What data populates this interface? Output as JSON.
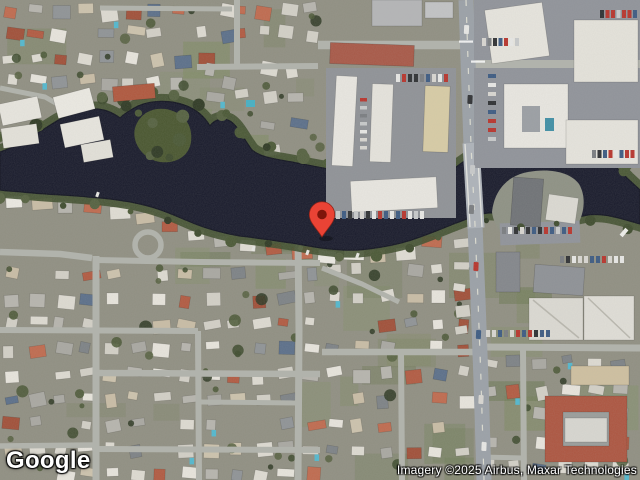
{
  "map": {
    "type": "satellite",
    "provider_logo_text": "Google",
    "attribution_text": "Imagery ©2025 Airbus, Maxar Technologies",
    "marker": {
      "x": 322,
      "y": 237,
      "color": "#EA4335",
      "inner_color": "#7E150B"
    }
  },
  "colors": {
    "ground": "#908f82",
    "water": "#181a2b",
    "water_edge": "#10121f",
    "bank_vegetation": "#41502f",
    "road_major": "#9ba1a8",
    "road_minor": "#b1b3ac",
    "bridge_deck": "#aeb3ba",
    "parking_lot": "#90939a"
  }
}
